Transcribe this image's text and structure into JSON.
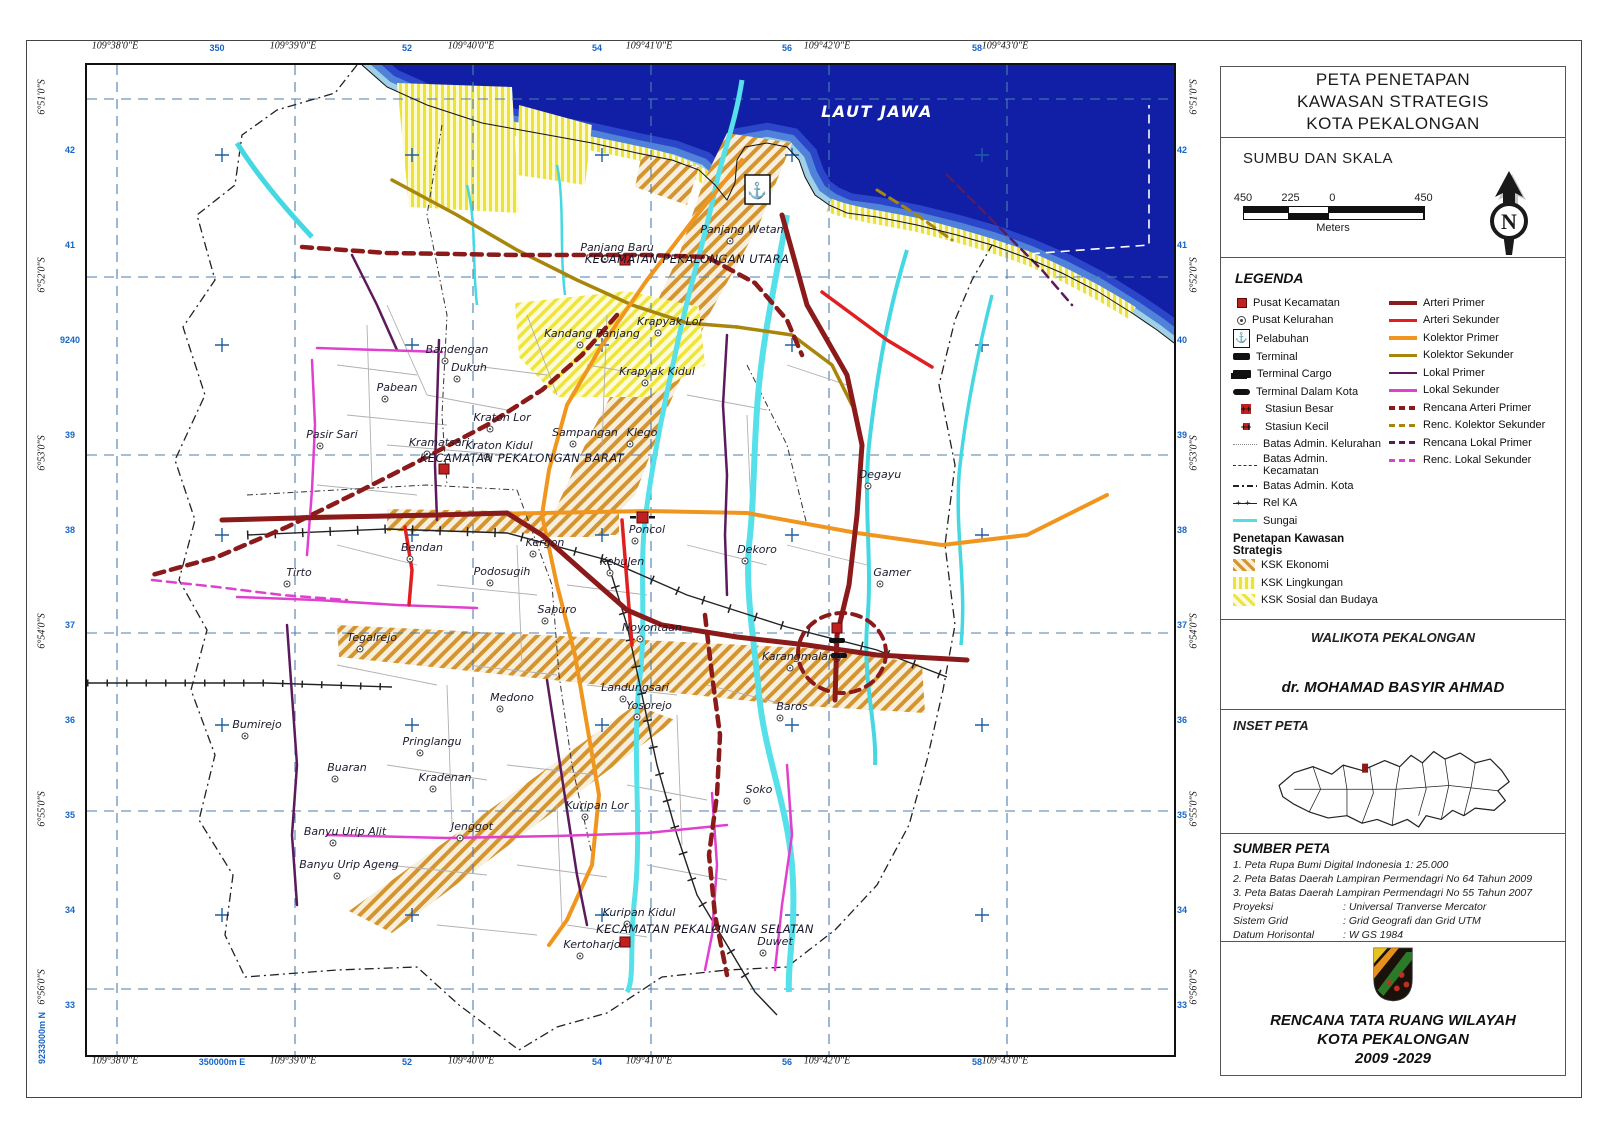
{
  "panel": {
    "title_lines": [
      "PETA PENETAPAN",
      "KAWASAN STRATEGIS",
      "KOTA PEKALONGAN"
    ],
    "scale": {
      "heading": "SUMBU DAN SKALA",
      "ticks": [
        "450",
        "225",
        "0",
        "450"
      ],
      "unit": "Meters",
      "north": "N"
    },
    "legend": {
      "heading": "LEGENDA",
      "points": [
        {
          "label": "Pusat Kecamatan",
          "swatch": "sw-sq-red"
        },
        {
          "label": "Pusat Kelurahan",
          "swatch": "sw-circ"
        },
        {
          "label": "Pelabuhan",
          "swatch": "sw-anchor",
          "glyph": "⚓"
        },
        {
          "label": "Terminal",
          "swatch": "sw-terminal"
        },
        {
          "label": "Terminal Cargo",
          "swatch": "sw-cargo"
        },
        {
          "label": "Terminal Dalam Kota",
          "swatch": "sw-terminal2"
        },
        {
          "label": "Stasiun Besar",
          "swatch": "sw-stbesar"
        },
        {
          "label": "Stasiun Kecil",
          "swatch": "sw-stkecil"
        },
        {
          "label": "Batas Admin. Kelurahan",
          "swatch": "sw-bkel"
        },
        {
          "label": "Batas Admin. Kecamatan",
          "swatch": "sw-bkec"
        },
        {
          "label": "Batas Admin. Kota",
          "swatch": "sw-bkota"
        },
        {
          "label": "Rel KA",
          "swatch": "sw-rel"
        },
        {
          "label": "Sungai",
          "swatch": "sw-sungai"
        }
      ],
      "ksk_heading": "Penetapan Kawasan Strategis",
      "ksk": [
        {
          "label": "KSK Ekonomi",
          "swatch": "sw-eko"
        },
        {
          "label": "KSK Lingkungan",
          "swatch": "sw-ling"
        },
        {
          "label": "KSK Sosial dan Budaya",
          "swatch": "sw-sos"
        }
      ],
      "lines": [
        {
          "label": "Arteri Primer",
          "swatch": "sw-ap"
        },
        {
          "label": "Arteri Sekunder",
          "swatch": "sw-as"
        },
        {
          "label": "Kolektor Primer",
          "swatch": "sw-kp"
        },
        {
          "label": "Kolektor Sekunder",
          "swatch": "sw-ks"
        },
        {
          "label": "Lokal Primer",
          "swatch": "sw-lp"
        },
        {
          "label": "Lokal Sekunder",
          "swatch": "sw-ls"
        },
        {
          "label": "Rencana Arteri Primer",
          "swatch": "sw-rap"
        },
        {
          "label": "Renc. Kolektor Sekunder",
          "swatch": "sw-rks"
        },
        {
          "label": "Rencana Lokal Primer",
          "swatch": "sw-rlp"
        },
        {
          "label": "Renc. Lokal Sekunder",
          "swatch": "sw-rls"
        }
      ]
    },
    "walikota": {
      "heading": "WALIKOTA PEKALONGAN",
      "name": "dr. MOHAMAD BASYIR AHMAD"
    },
    "inset": {
      "heading": "INSET PETA"
    },
    "sumber": {
      "heading": "SUMBER PETA",
      "items": [
        "1. Peta Rupa Bumi Digital Indonesia 1: 25.000",
        "2. Peta Batas Daerah Lampiran Permendagri No 64 Tahun 2009",
        "3. Peta Batas Daerah Lampiran Permendagri No 55 Tahun 2007"
      ],
      "meta": [
        {
          "k": "Proyeksi",
          "v": ": Universal Tranverse Mercator"
        },
        {
          "k": "Sistem Grid",
          "v": ": Grid Geografi dan Grid UTM"
        },
        {
          "k": "Datum Horisontal",
          "v": ": W GS 1984"
        }
      ]
    },
    "footer": {
      "lines": [
        "RENCANA TATA RUANG WILAYAH",
        "KOTA PEKALONGAN",
        "2009 -2029"
      ]
    }
  },
  "frame": {
    "top": [
      {
        "t": "109°38'0\"E",
        "x": 115,
        "k": "geo"
      },
      {
        "t": "350",
        "x": 217,
        "k": "utm"
      },
      {
        "t": "109°39'0\"E",
        "x": 293,
        "k": "geo"
      },
      {
        "t": "52",
        "x": 407,
        "k": "utm"
      },
      {
        "t": "109°40'0\"E",
        "x": 471,
        "k": "geo"
      },
      {
        "t": "54",
        "x": 597,
        "k": "utm"
      },
      {
        "t": "109°41'0\"E",
        "x": 649,
        "k": "geo"
      },
      {
        "t": "56",
        "x": 787,
        "k": "utm"
      },
      {
        "t": "109°42'0\"E",
        "x": 827,
        "k": "geo"
      },
      {
        "t": "58",
        "x": 977,
        "k": "utm"
      },
      {
        "t": "109°43'0\"E",
        "x": 1005,
        "k": "geo"
      }
    ],
    "bottom": [
      {
        "t": "109°38'0\"E",
        "x": 115,
        "k": "geo"
      },
      {
        "t": "350000m E",
        "x": 222,
        "k": "utm"
      },
      {
        "t": "109°39'0\"E",
        "x": 293,
        "k": "geo"
      },
      {
        "t": "52",
        "x": 407,
        "k": "utm"
      },
      {
        "t": "109°40'0\"E",
        "x": 471,
        "k": "geo"
      },
      {
        "t": "54",
        "x": 597,
        "k": "utm"
      },
      {
        "t": "109°41'0\"E",
        "x": 649,
        "k": "geo"
      },
      {
        "t": "56",
        "x": 787,
        "k": "utm"
      },
      {
        "t": "109°42'0\"E",
        "x": 827,
        "k": "geo"
      },
      {
        "t": "58",
        "x": 977,
        "k": "utm"
      },
      {
        "t": "109°43'0\"E",
        "x": 1005,
        "k": "geo"
      }
    ],
    "left": [
      {
        "t": "6°51'0\"S",
        "y": 97,
        "k": "geo",
        "v": 1
      },
      {
        "t": "42",
        "y": 150,
        "k": "utm"
      },
      {
        "t": "41",
        "y": 245,
        "k": "utm"
      },
      {
        "t": "6°52'0\"S",
        "y": 275,
        "k": "geo",
        "v": 1
      },
      {
        "t": "9240",
        "y": 340,
        "k": "utm"
      },
      {
        "t": "39",
        "y": 435,
        "k": "utm"
      },
      {
        "t": "6°53'0\"S",
        "y": 453,
        "k": "geo",
        "v": 1
      },
      {
        "t": "38",
        "y": 530,
        "k": "utm"
      },
      {
        "t": "37",
        "y": 625,
        "k": "utm"
      },
      {
        "t": "6°54'0\"S",
        "y": 631,
        "k": "geo",
        "v": 1
      },
      {
        "t": "36",
        "y": 720,
        "k": "utm"
      },
      {
        "t": "35",
        "y": 815,
        "k": "utm"
      },
      {
        "t": "6°55'0\"S",
        "y": 809,
        "k": "geo",
        "v": 1
      },
      {
        "t": "34",
        "y": 910,
        "k": "utm"
      },
      {
        "t": "6°56'0\"S",
        "y": 987,
        "k": "geo",
        "v": 1
      },
      {
        "t": "33",
        "y": 1005,
        "k": "utm"
      },
      {
        "t": "9233000m N",
        "y": 1038,
        "k": "utm",
        "v": 1
      }
    ],
    "right": [
      {
        "t": "6°51'0\"S",
        "y": 97,
        "k": "geo",
        "v": 1
      },
      {
        "t": "42",
        "y": 150,
        "k": "utm"
      },
      {
        "t": "41",
        "y": 245,
        "k": "utm"
      },
      {
        "t": "6°52'0\"S",
        "y": 275,
        "k": "geo",
        "v": 1
      },
      {
        "t": "40",
        "y": 340,
        "k": "utm"
      },
      {
        "t": "39",
        "y": 435,
        "k": "utm"
      },
      {
        "t": "6°53'0\"S",
        "y": 453,
        "k": "geo",
        "v": 1
      },
      {
        "t": "38",
        "y": 530,
        "k": "utm"
      },
      {
        "t": "37",
        "y": 625,
        "k": "utm"
      },
      {
        "t": "6°54'0\"S",
        "y": 631,
        "k": "geo",
        "v": 1
      },
      {
        "t": "36",
        "y": 720,
        "k": "utm"
      },
      {
        "t": "35",
        "y": 815,
        "k": "utm"
      },
      {
        "t": "6°55'0\"S",
        "y": 809,
        "k": "geo",
        "v": 1
      },
      {
        "t": "34",
        "y": 910,
        "k": "utm"
      },
      {
        "t": "6°56'0\"S",
        "y": 987,
        "k": "geo",
        "v": 1
      },
      {
        "t": "33",
        "y": 1005,
        "k": "utm"
      }
    ]
  },
  "map": {
    "labels": [
      {
        "t": "LAUT JAWA",
        "x": 790,
        "y": 52,
        "k": "sea"
      },
      {
        "t": "KECAMATAN PEKALONGAN UTARA",
        "x": 600,
        "y": 198,
        "k": "kec"
      },
      {
        "t": "KECAMATAN PEKALONGAN BARAT",
        "x": 435,
        "y": 397,
        "k": "kec"
      },
      {
        "t": "KECAMATAN PEKALONGAN SELATAN",
        "x": 618,
        "y": 868,
        "k": "kec"
      },
      {
        "t": "Panjang Baru",
        "x": 530,
        "y": 186,
        "k": "kel"
      },
      {
        "t": "Panjang Wetan",
        "x": 655,
        "y": 168,
        "k": "kel"
      },
      {
        "t": "Krapyak Lor",
        "x": 583,
        "y": 260,
        "k": "kel"
      },
      {
        "t": "Kandang Panjang",
        "x": 505,
        "y": 272,
        "k": "kel"
      },
      {
        "t": "Bandengan",
        "x": 370,
        "y": 288,
        "k": "kel"
      },
      {
        "t": "Dukuh",
        "x": 382,
        "y": 306,
        "k": "kel"
      },
      {
        "t": "Krapyak Kidul",
        "x": 570,
        "y": 310,
        "k": "kel"
      },
      {
        "t": "Pabean",
        "x": 310,
        "y": 326,
        "k": "kel"
      },
      {
        "t": "Kraton Lor",
        "x": 415,
        "y": 356,
        "k": "kel"
      },
      {
        "t": "Sampangan",
        "x": 498,
        "y": 371,
        "k": "kel"
      },
      {
        "t": "Klego",
        "x": 555,
        "y": 371,
        "k": "kel"
      },
      {
        "t": "Kraton Kidul",
        "x": 412,
        "y": 384,
        "k": "kel"
      },
      {
        "t": "Kramatsari",
        "x": 352,
        "y": 381,
        "k": "kel"
      },
      {
        "t": "Pasir Sari",
        "x": 245,
        "y": 373,
        "k": "kel"
      },
      {
        "t": "Degayu",
        "x": 793,
        "y": 413,
        "k": "kel"
      },
      {
        "t": "Bendan",
        "x": 335,
        "y": 486,
        "k": "kel"
      },
      {
        "t": "Kergon",
        "x": 458,
        "y": 481,
        "k": "kel"
      },
      {
        "t": "Tirto",
        "x": 212,
        "y": 511,
        "k": "kel"
      },
      {
        "t": "Podosugih",
        "x": 415,
        "y": 510,
        "k": "kel"
      },
      {
        "t": "Kebulen",
        "x": 535,
        "y": 500,
        "k": "kel"
      },
      {
        "t": "Poncol",
        "x": 560,
        "y": 468,
        "k": "kel"
      },
      {
        "t": "Dekoro",
        "x": 670,
        "y": 488,
        "k": "kel"
      },
      {
        "t": "Gamer",
        "x": 805,
        "y": 511,
        "k": "kel"
      },
      {
        "t": "Sapuro",
        "x": 470,
        "y": 548,
        "k": "kel"
      },
      {
        "t": "Noyontaan",
        "x": 565,
        "y": 566,
        "k": "kel"
      },
      {
        "t": "Karangmalang",
        "x": 715,
        "y": 595,
        "k": "kel"
      },
      {
        "t": "Tegalrejo",
        "x": 285,
        "y": 576,
        "k": "kel"
      },
      {
        "t": "Landungsari",
        "x": 548,
        "y": 626,
        "k": "kel"
      },
      {
        "t": "Yosorejo",
        "x": 562,
        "y": 644,
        "k": "kel"
      },
      {
        "t": "Baros",
        "x": 705,
        "y": 645,
        "k": "kel"
      },
      {
        "t": "Medono",
        "x": 425,
        "y": 636,
        "k": "kel"
      },
      {
        "t": "Pringlangu",
        "x": 345,
        "y": 680,
        "k": "kel"
      },
      {
        "t": "Buaran",
        "x": 260,
        "y": 706,
        "k": "kel"
      },
      {
        "t": "Kradenan",
        "x": 358,
        "y": 716,
        "k": "kel"
      },
      {
        "t": "Bumirejo",
        "x": 170,
        "y": 663,
        "k": "kel"
      },
      {
        "t": "Banyu Urip Alit",
        "x": 258,
        "y": 770,
        "k": "kel"
      },
      {
        "t": "Banyu Urip Ageng",
        "x": 262,
        "y": 803,
        "k": "kel"
      },
      {
        "t": "Jenggot",
        "x": 385,
        "y": 765,
        "k": "kel"
      },
      {
        "t": "Kuripan Lor",
        "x": 510,
        "y": 744,
        "k": "kel"
      },
      {
        "t": "Soko",
        "x": 672,
        "y": 728,
        "k": "kel"
      },
      {
        "t": "Kuripan Kidul",
        "x": 552,
        "y": 851,
        "k": "kel"
      },
      {
        "t": "Kertoharjo",
        "x": 505,
        "y": 883,
        "k": "kel"
      },
      {
        "t": "Duwet",
        "x": 688,
        "y": 880,
        "k": "kel"
      }
    ],
    "port_icon": "⚓"
  },
  "colors": {
    "sea": "#101fa6",
    "arteri_primer": "#8b1a1a",
    "arteri_sekunder": "#e02020",
    "kolektor_primer": "#f0951e",
    "kolektor_sekunder": "#a8860b",
    "lokal_primer": "#5c1a5c",
    "lokal_sekunder": "#e040d0",
    "sungai": "#45d8e2",
    "ksk_ekonomi": "#d4952e",
    "ksk_lingkungan": "#ece23a",
    "graticule": "#4d7fae"
  }
}
